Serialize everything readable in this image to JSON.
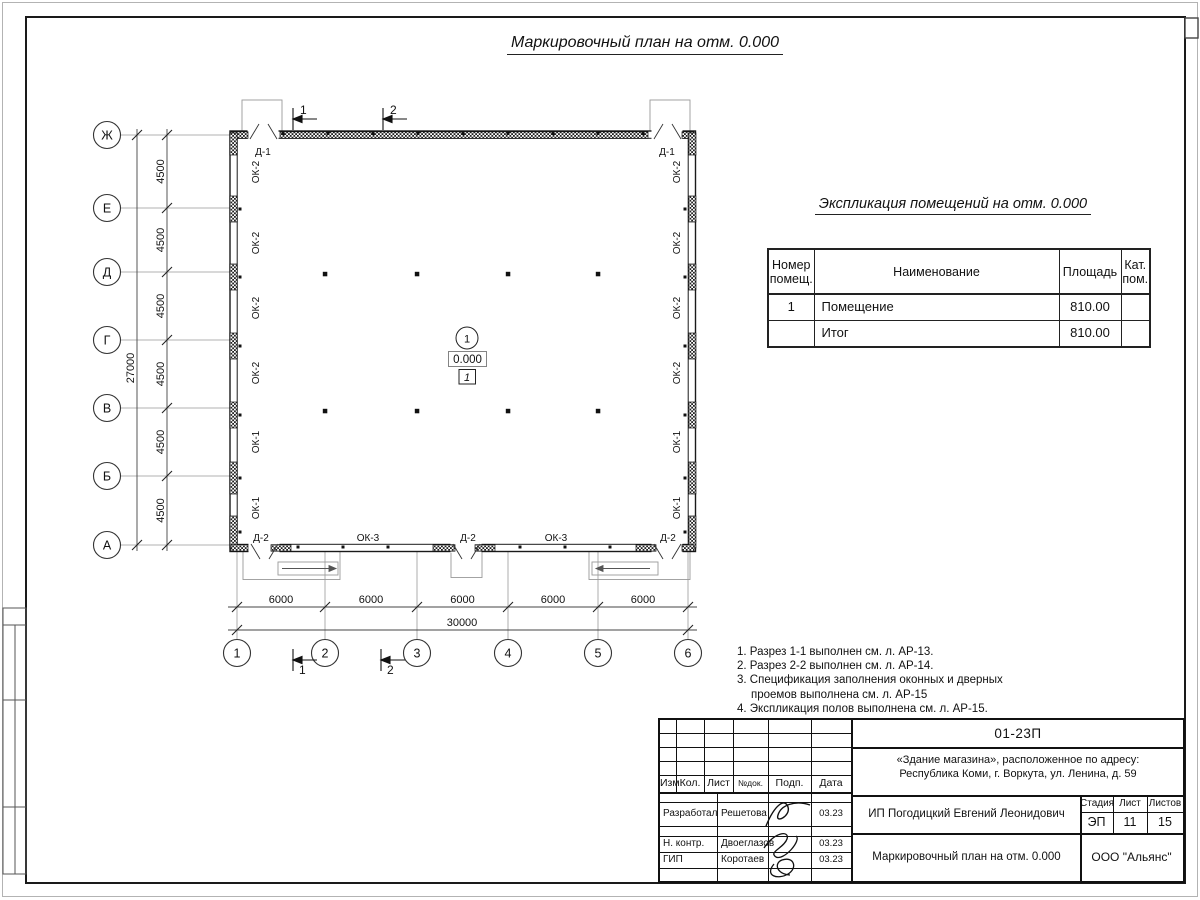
{
  "page": {
    "main_title": "Маркировочный план на отм. 0.000"
  },
  "plan": {
    "row_axes": [
      "Ж",
      "Е",
      "Д",
      "Г",
      "В",
      "Б",
      "А"
    ],
    "col_axes": [
      "1",
      "2",
      "3",
      "4",
      "5",
      "6"
    ],
    "v_dims": [
      "4500",
      "4500",
      "4500",
      "4500",
      "4500",
      "4500"
    ],
    "v_total": "27000",
    "h_dims": [
      "6000",
      "6000",
      "6000",
      "6000",
      "6000"
    ],
    "h_total": "30000",
    "left_wall_labels": [
      "ОК-2",
      "ОК-2",
      "ОК-2",
      "ОК-2",
      "ОК-1",
      "ОК-1"
    ],
    "right_wall_labels": [
      "ОК-2",
      "ОК-2",
      "ОК-2",
      "ОК-2",
      "ОК-1",
      "ОК-1"
    ],
    "top_door_labels": [
      "Д-1",
      "Д-1"
    ],
    "bottom_wall_labels": [
      "Д-2",
      "ОК-3",
      "Д-2",
      "ОК-3",
      "Д-2"
    ],
    "section_marks": [
      "1",
      "2"
    ],
    "room_number": "1",
    "elevation": "0.000",
    "floor_type": "1"
  },
  "spec_table": {
    "title": "Экспликация помещений на отм. 0.000",
    "col_headers": [
      "Номер помещ.",
      "Наименование",
      "Площадь",
      "Кат. пом."
    ],
    "rows": [
      {
        "num": "1",
        "name": "Помещение",
        "area": "810.00",
        "cat": ""
      },
      {
        "num": "",
        "name": "Итог",
        "area": "810.00",
        "cat": ""
      }
    ]
  },
  "notes": {
    "lines": [
      "1. Разрез 1-1 выполнен см. л. АР-13.",
      "2. Разрез 2-2 выполнен см. л. АР-14.",
      "3. Спецификация заполнения оконных и дверных",
      "проемов выполнена см. л. АР-15",
      "4. Экспликация полов выполнена см. л. АР-15."
    ]
  },
  "title_block": {
    "doc_number": "01-23П",
    "object_address_line1": "«Здание магазина», расположенное по адресу:",
    "object_address_line2": "Республика Коми, г. Воркута, ул. Ленина, д. 59",
    "header_cols": [
      "Изм.",
      "Кол.",
      "Лист",
      "№док.",
      "Подп.",
      "Дата"
    ],
    "signature_rows": [
      {
        "role": "Разработал",
        "name": "Решетова",
        "date": "03.23"
      },
      {
        "role": "Н. контр.",
        "name": "Двоеглазов",
        "date": "03.23"
      },
      {
        "role": "ГИП",
        "name": "Коротаев",
        "date": "03.23"
      }
    ],
    "client": "ИП Погодицкий Евгений Леонидович",
    "stage_label": "Стадия",
    "sheet_label": "Лист",
    "sheets_label": "Листов",
    "stage": "ЭП",
    "sheet_number": "11",
    "sheets_total": "15",
    "drawing_name": "Маркировочный план на отм. 0.000",
    "company": "ООО \"Альянс\""
  }
}
